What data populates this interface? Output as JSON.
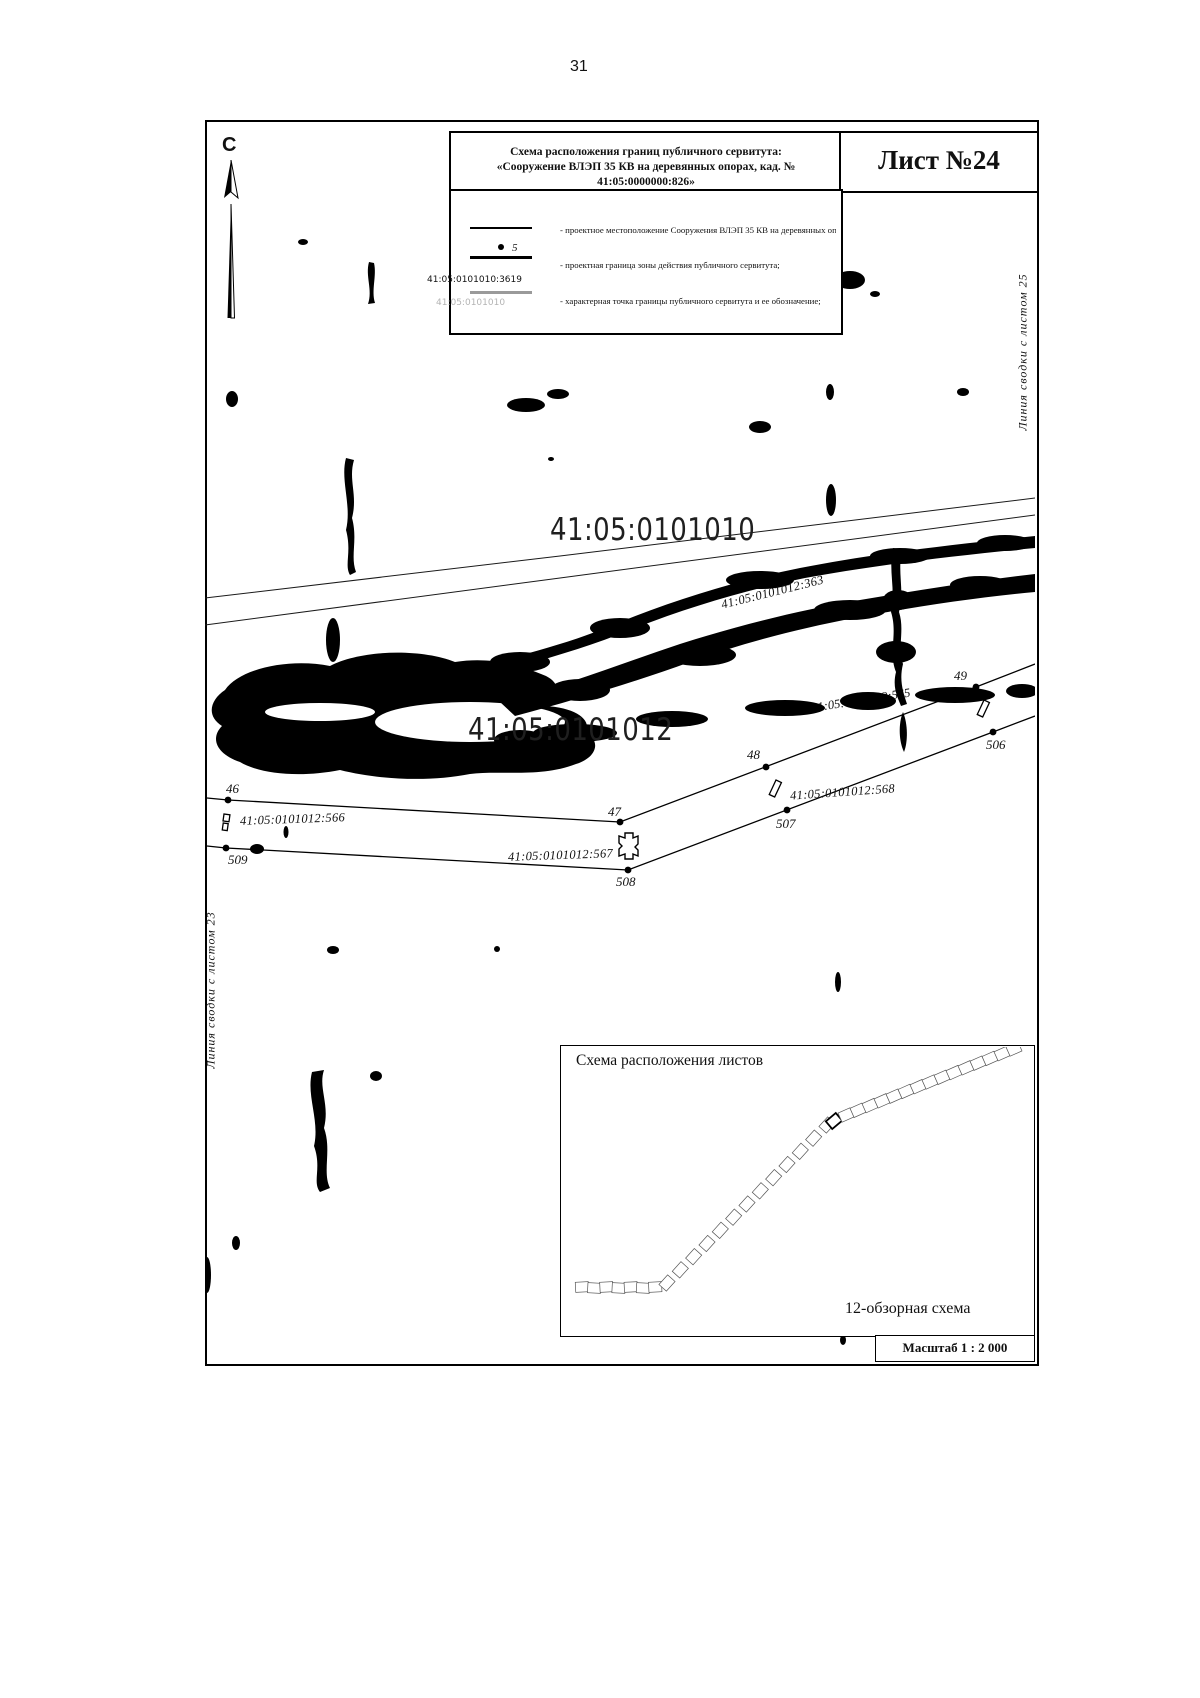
{
  "page": {
    "number": "31"
  },
  "header": {
    "title_line1": "Схема расположения границ публичного сервитута:",
    "title_line2": "«Сооружение ВЛЭП 35 КВ на деревянных опорах, кад. № 41:05:0000000:826»",
    "sheet_label": "Лист №24"
  },
  "compass": {
    "label": "С"
  },
  "legend": {
    "symbols": {
      "point_label": "5",
      "parcel_number": "41:05:0101010:3619",
      "quarter_number_ghost": "41:05:0101010"
    },
    "items": [
      "- проектное местоположение Сооружения ВЛЭП 35 КВ на деревянных опорах;",
      "- проектная граница зоны действия публичного сервитута;",
      "- характерная точка границы публичного сервитута и ее обозначение;",
      "- граница  земельных участков, сведения о которой в ЕГРН,\n  достаточны для определения ее местоположения;",
      "- кадастровый номер земельного участка;",
      "- граница кадастрового квартала;",
      "- номер кадастрового квартала;",
      "- установленная граница административно-территориального\n  образования;",
      "- реестровый номер границы административно-территориального  образования."
    ]
  },
  "map": {
    "quarter_labels": [
      "41:05:0101010",
      "41:05:0101012"
    ],
    "parcel_labels": [
      "41:05:0101012:363",
      "41:05:0101012:565",
      "41:05:0101012:566",
      "41:05:0101012:567",
      "41:05:0101012:568"
    ],
    "points": [
      "46",
      "47",
      "48",
      "49",
      "506",
      "507",
      "508",
      "509"
    ],
    "edge_notes": {
      "left": "Линия сводки с листом 23",
      "right": "Линия сводки с листом 25"
    }
  },
  "inset": {
    "title": "Схема расположения листов",
    "caption": "12-обзорная схема"
  },
  "scale": {
    "label": "Масштаб 1 : 2 000"
  }
}
